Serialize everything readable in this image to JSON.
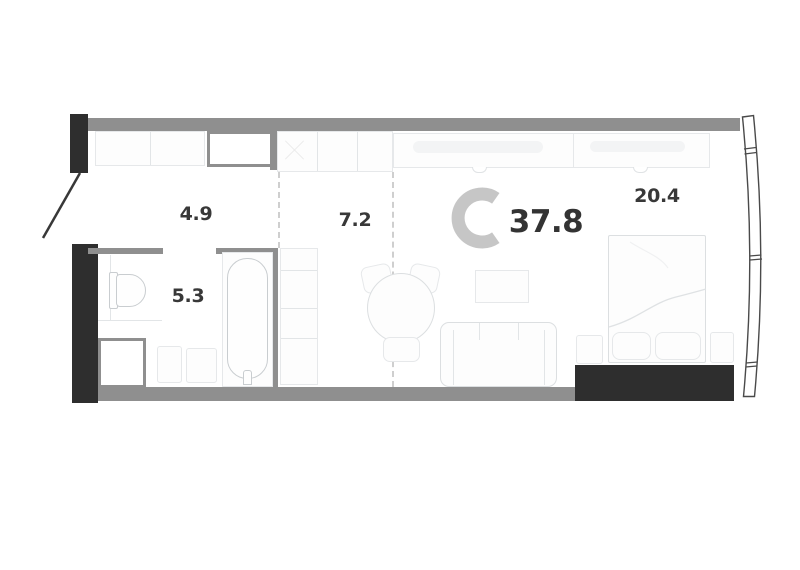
{
  "plan": {
    "logo_letter": "C",
    "total_area": "37.8",
    "rooms": {
      "hallway": {
        "area": "4.9"
      },
      "kitchen": {
        "area": "7.2"
      },
      "bathroom": {
        "area": "5.3"
      },
      "living_room": {
        "area": "20.4"
      }
    },
    "colors": {
      "background": "#ffffff",
      "wall_dark": "#2e2e2e",
      "wall_gray": "#8f8f8f",
      "furniture_outline": "#dcdfe1",
      "fixture_outline": "#c9cdd0",
      "dashed_divider": "#cfcfcf",
      "label_text": "#383838",
      "logo_gray": "#c6c6c6"
    }
  }
}
